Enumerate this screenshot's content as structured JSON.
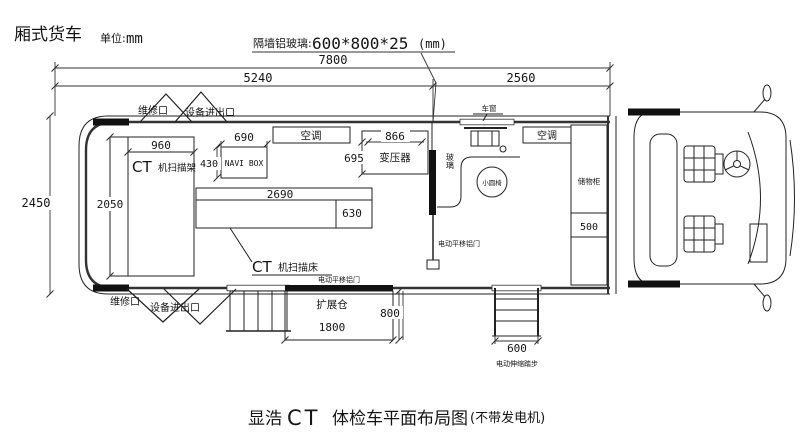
{
  "header": {
    "vehicle_type": "厢式货车",
    "unit_label": "单位:",
    "unit_value": "mm",
    "note_label": "隔墙铝玻璃:",
    "note_value": "600*800*25",
    "note_unit": "(mm)"
  },
  "dims": {
    "total_length": "7800",
    "box_length": "5240",
    "cab_length": "2560",
    "body_width": "2450",
    "ct_room_depth": "2050",
    "ct_room_width": "960",
    "navi_width": "690",
    "navi_depth": "430",
    "transformer_width": "866",
    "transformer_depth": "695",
    "bed_length": "2690",
    "bed_width": "630",
    "cabinet_depth": "500",
    "expansion_length": "1800",
    "expansion_depth": "800",
    "steps_width": "600"
  },
  "rooms": {
    "ct_label": "CT",
    "ct_name": "机扫描架",
    "navi": "NAVI BOX",
    "ac": "空调",
    "ac2": "空调",
    "transformer": "变压器",
    "bed_label": "CT",
    "bed_name": "机扫描床",
    "window": "车窗",
    "glass": "玻璃",
    "stool": "小圆椅",
    "cabinet": "储物柜",
    "expansion": "扩展仓"
  },
  "doors": {
    "maintenance_top_1": "维修口",
    "maintenance_top_2": "设备进出口",
    "maintenance_bottom_1": "维修口",
    "maintenance_bottom_2": "设备进出口",
    "sliding_mid": "电动平移铝门",
    "sliding_bottom": "电动平移铝门",
    "telescopic_steps": "电动伸缩踏步"
  },
  "title": {
    "prefix": "显浩",
    "ct": "CT",
    "main": "体检车平面布局图",
    "suffix": "(不带发电机)"
  }
}
